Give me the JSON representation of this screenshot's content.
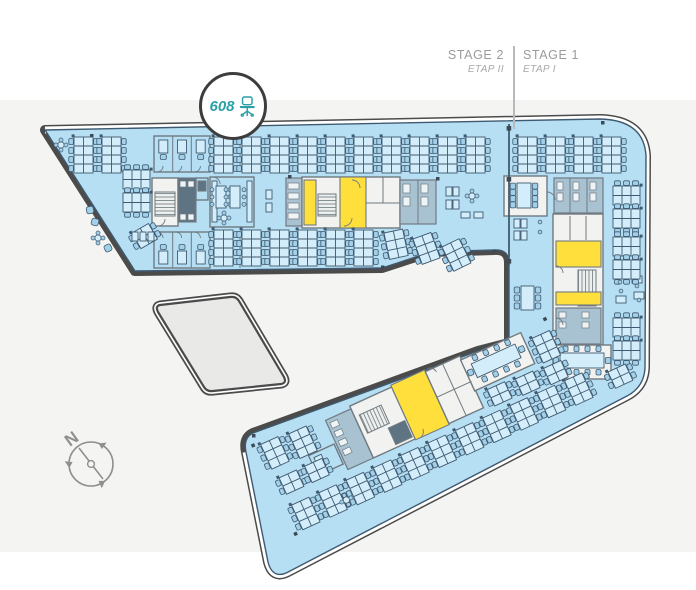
{
  "header": {
    "stages": [
      {
        "title": "STAGE 2",
        "subtitle": "ETAP II"
      },
      {
        "title": "STAGE 1",
        "subtitle": "ETAP I"
      }
    ]
  },
  "marker": {
    "value": "608",
    "icon": "office-chair-icon"
  },
  "compass": {
    "label": "N"
  },
  "colors": {
    "accent": "#2da0a6",
    "outline": "#4b4b4b",
    "band": "#f4f4f3",
    "label": "#9b9b9b",
    "floor": "#b7dff3",
    "line": "#3f5a70",
    "desk": "#d4edfb",
    "chair": "#a3d0e9",
    "room": "#f2f2f0",
    "wall": "#6f7a81",
    "highlight": "#ffdf3c",
    "service": "#a8c2d2",
    "service_dark": "#5f7482",
    "annex": "#e9e9e8",
    "hatch": "#7a868c",
    "compass_gray": "#8f8f8f"
  }
}
